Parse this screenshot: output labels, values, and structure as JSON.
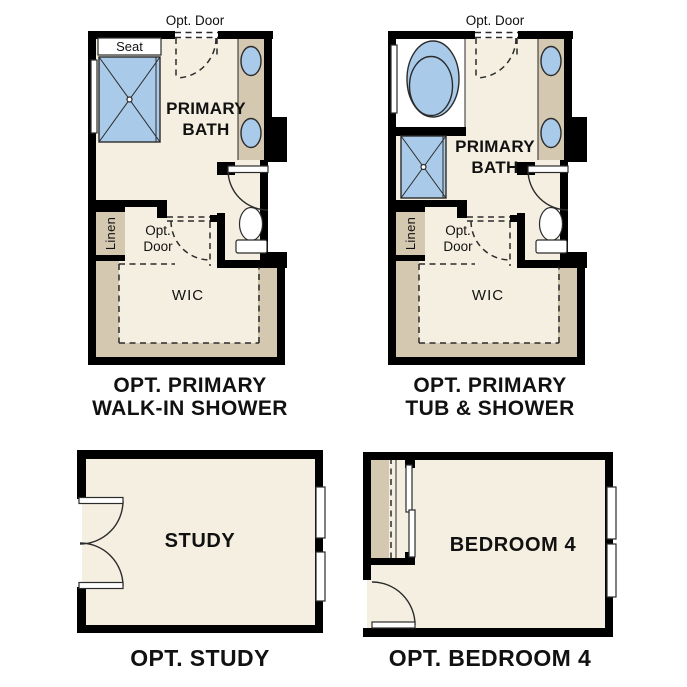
{
  "colors": {
    "wall": "#000000",
    "floor": "#f4efe1",
    "tan": "#d5c8b1",
    "fixture": "#a9cbe9",
    "line": "#2b2b2b",
    "text": "#111111",
    "bg": "#ffffff"
  },
  "plans": {
    "p1": {
      "opt_door": "Opt. Door",
      "seat": "Seat",
      "room_line1": "PRIMARY",
      "room_line2": "BATH",
      "linen": "Linen",
      "opt": "Opt.",
      "door": "Door",
      "wic": "WIC",
      "caption_line1": "OPT. PRIMARY",
      "caption_line2": "WALK-IN SHOWER"
    },
    "p2": {
      "opt_door": "Opt. Door",
      "room_line1": "PRIMARY",
      "room_line2": "BATH",
      "linen": "Linen",
      "opt": "Opt.",
      "door": "Door",
      "wic": "WIC",
      "caption_line1": "OPT. PRIMARY",
      "caption_line2": "TUB & SHOWER"
    },
    "p3": {
      "room": "STUDY",
      "caption": "OPT. STUDY"
    },
    "p4": {
      "room": "BEDROOM 4",
      "caption": "OPT. BEDROOM 4"
    }
  }
}
